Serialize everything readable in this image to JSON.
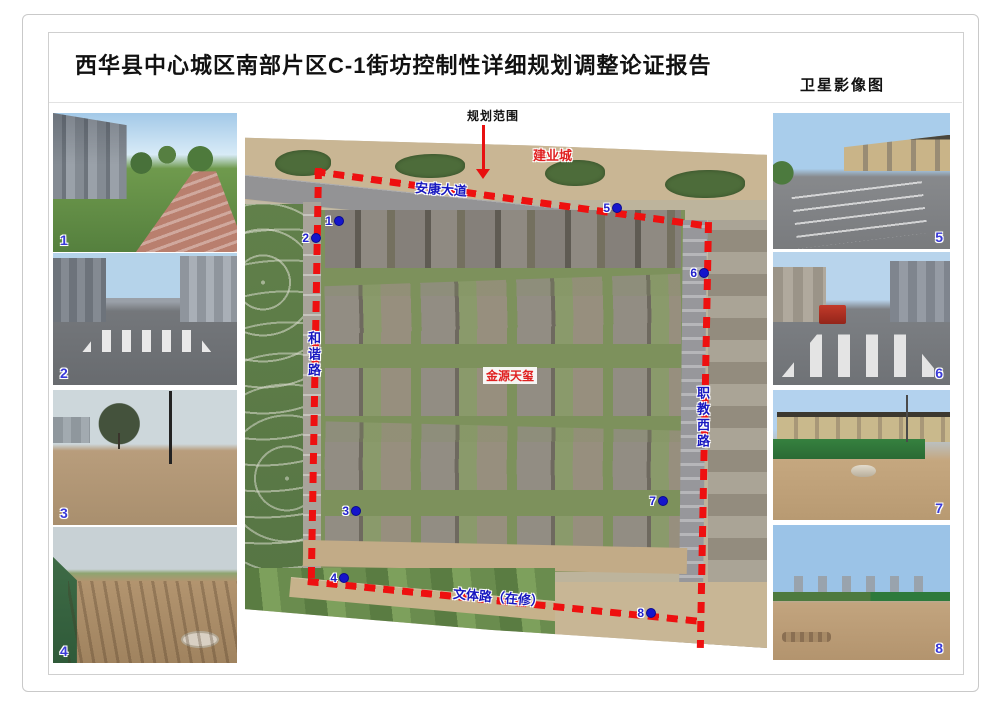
{
  "page": {
    "title": "西华县中心城区南部片区C-1街坊控制性详细规划调整论证报告",
    "map_type_label": "卫星影像图"
  },
  "map": {
    "scope_label": "规划范围",
    "boundary_color": "#ee1010",
    "marker_color": "#1515cc",
    "road_label_color": "#1818c0",
    "landmark_color": "#e02020",
    "landmarks": [
      {
        "name": "建业城"
      },
      {
        "name": "金源天玺"
      }
    ],
    "roads": [
      {
        "name": "安康大道"
      },
      {
        "name": "和谐路"
      },
      {
        "name": "职教西路"
      },
      {
        "name": "文体路（在修）"
      }
    ],
    "markers": [
      {
        "num": "1"
      },
      {
        "num": "2"
      },
      {
        "num": "3"
      },
      {
        "num": "4"
      },
      {
        "num": "5"
      },
      {
        "num": "6"
      },
      {
        "num": "7"
      },
      {
        "num": "8"
      }
    ]
  },
  "photos": {
    "left": [
      {
        "num": "1"
      },
      {
        "num": "2"
      },
      {
        "num": "3"
      },
      {
        "num": "4"
      }
    ],
    "right": [
      {
        "num": "5"
      },
      {
        "num": "6"
      },
      {
        "num": "7"
      },
      {
        "num": "8"
      }
    ]
  }
}
